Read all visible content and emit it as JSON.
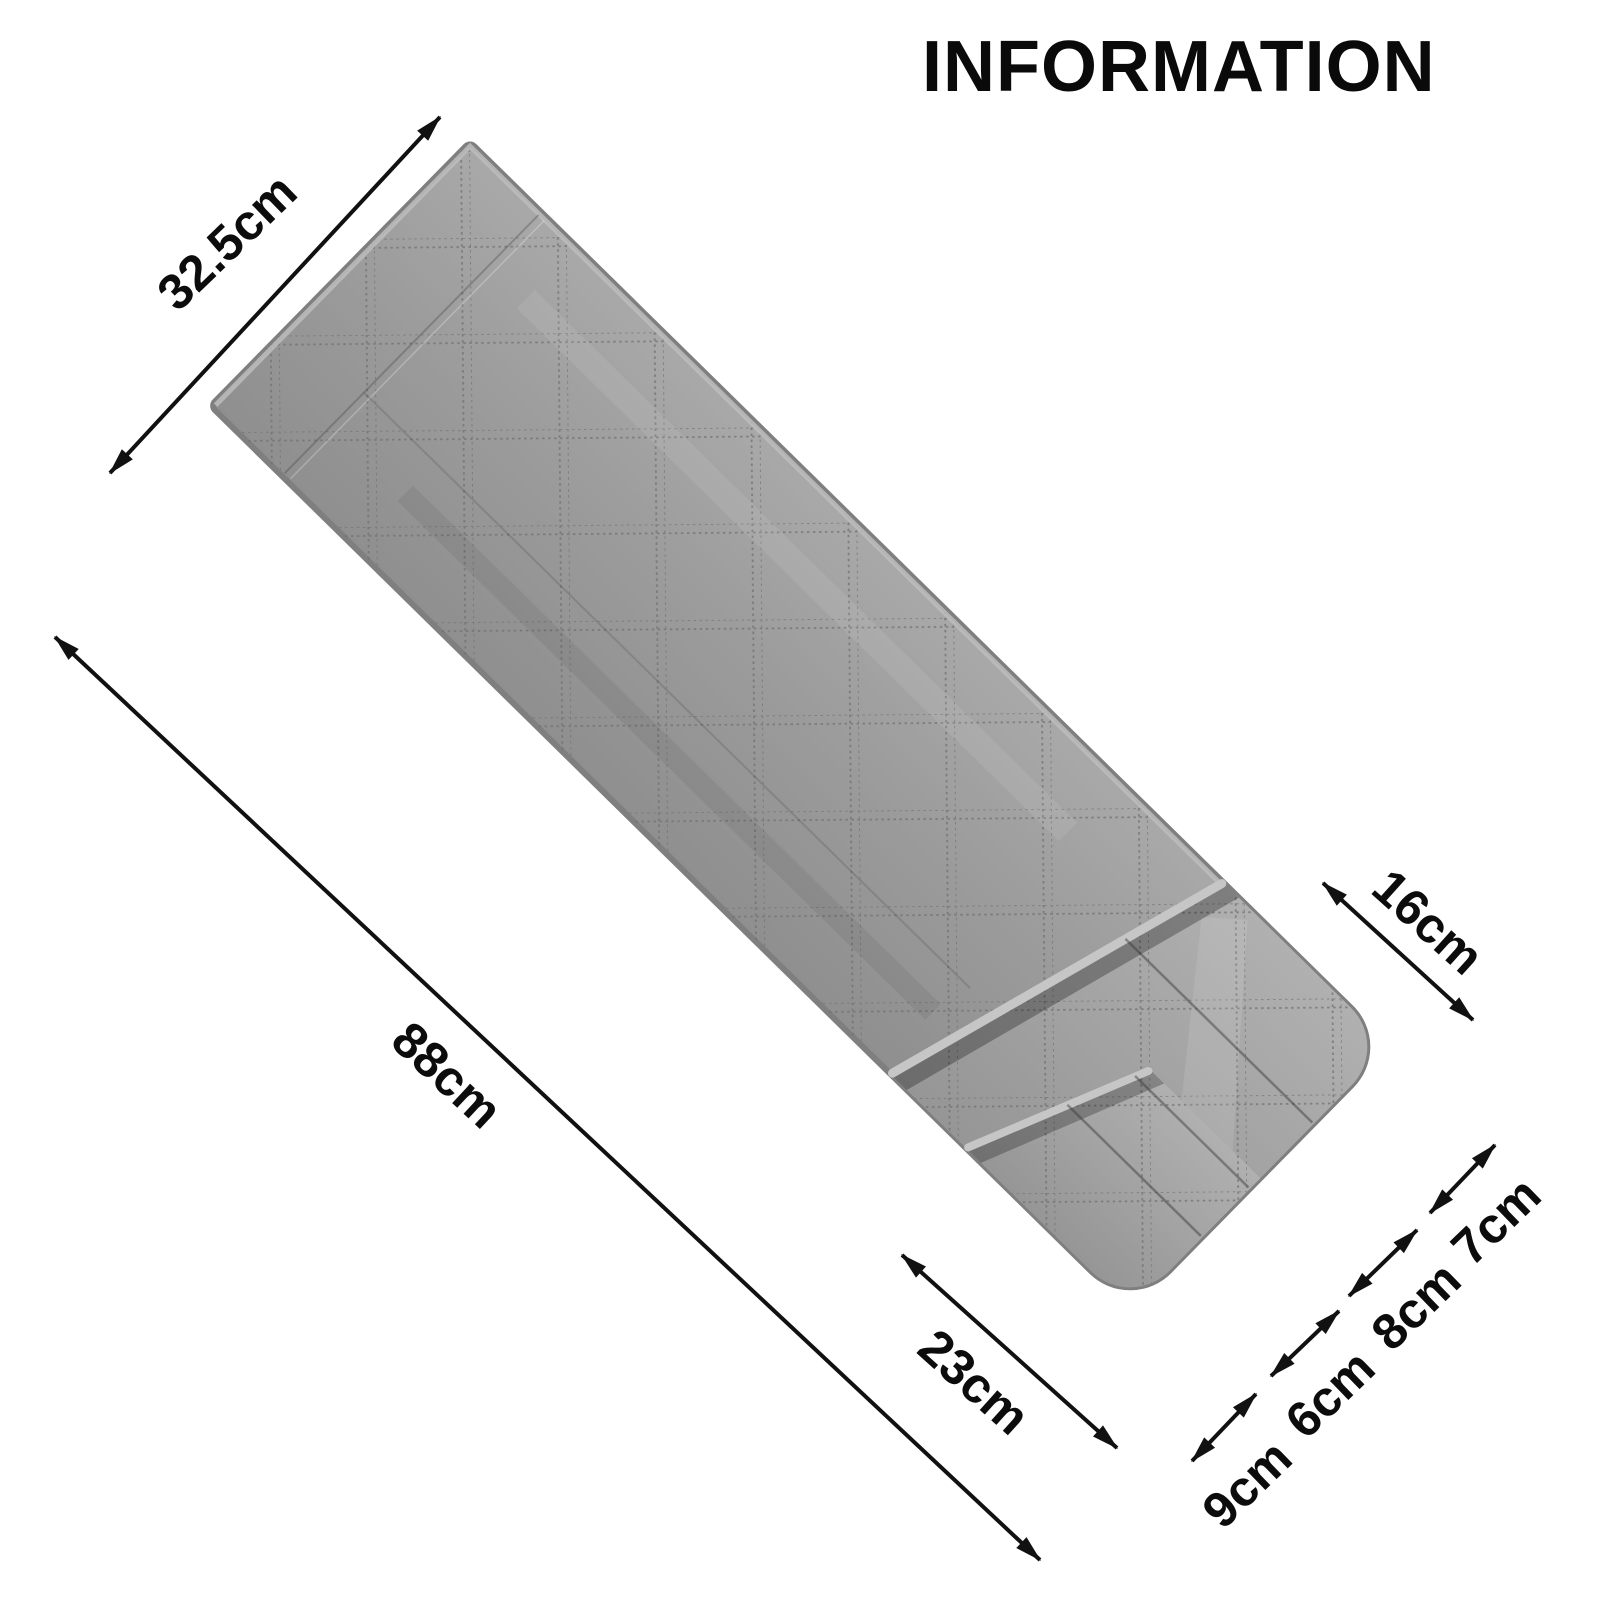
{
  "title": "INFORMATION",
  "product": {
    "type": "quilted armrest storage organizer",
    "fabric_color": "#9b9b9b",
    "fabric_shadow_color": "#8f8f8f",
    "binding_color": "#c6c6c6",
    "outline_color": "#7f7f7f",
    "stitch_color": "#6e6e6e",
    "background_color": "#ffffff",
    "annotation_color": "#111111"
  },
  "dimensions": {
    "top_width": {
      "label": "32.5cm"
    },
    "length": {
      "label": "88cm"
    },
    "side_pocket_depth": {
      "label": "16cm"
    },
    "pocket_panel_length": {
      "label": "23cm"
    },
    "pocket_widths": [
      {
        "label": "9cm"
      },
      {
        "label": "6cm"
      },
      {
        "label": "8cm"
      },
      {
        "label": "7cm"
      }
    ]
  }
}
